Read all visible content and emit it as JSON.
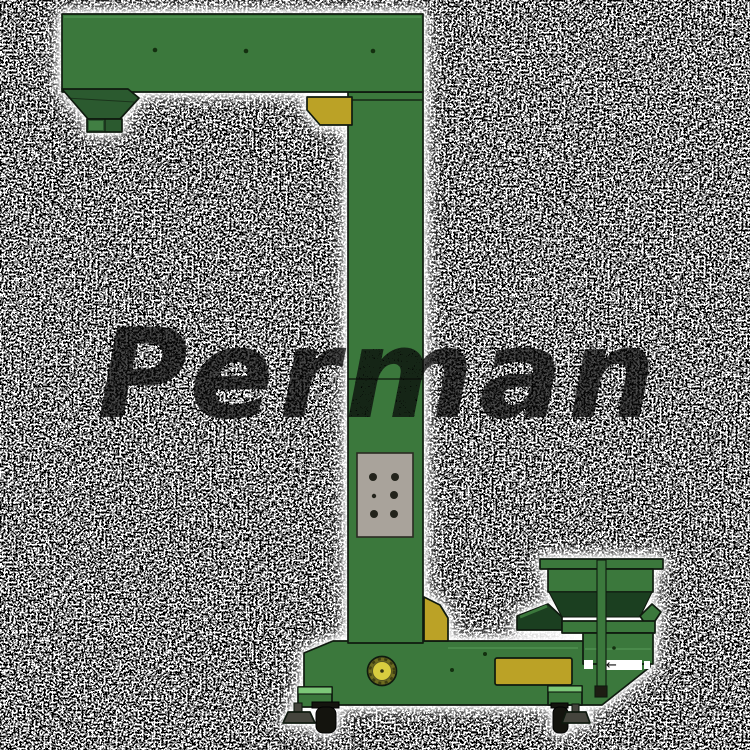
{
  "watermark": {
    "text": "Perman"
  },
  "control_panel": {
    "buttons": 6,
    "rows": 3,
    "columns": 2
  },
  "icons": {
    "arrow_left": "←"
  },
  "colors": {
    "body_green": "#3b783c",
    "body_green_edge": "#4c8c4c",
    "hopper_dark_green": "#2b5a2f",
    "hopper_deep_green": "#1b3f20",
    "step_light_green": "#7cc878",
    "accent_yellow": "#bba226",
    "motor_yellow": "#d8cd3f",
    "motor_ring_olive": "#6e6c20",
    "panel_gray": "#a9a39b",
    "button_dark": "#23231b",
    "outline_dark": "#0f1a0f",
    "wheel_black": "#14140e",
    "foot_gray": "#45453d",
    "halo_white": "#ffffff",
    "watermark_dark": "#0a0a0a",
    "background_white": "#ffffff",
    "noise_black": "#000000"
  }
}
